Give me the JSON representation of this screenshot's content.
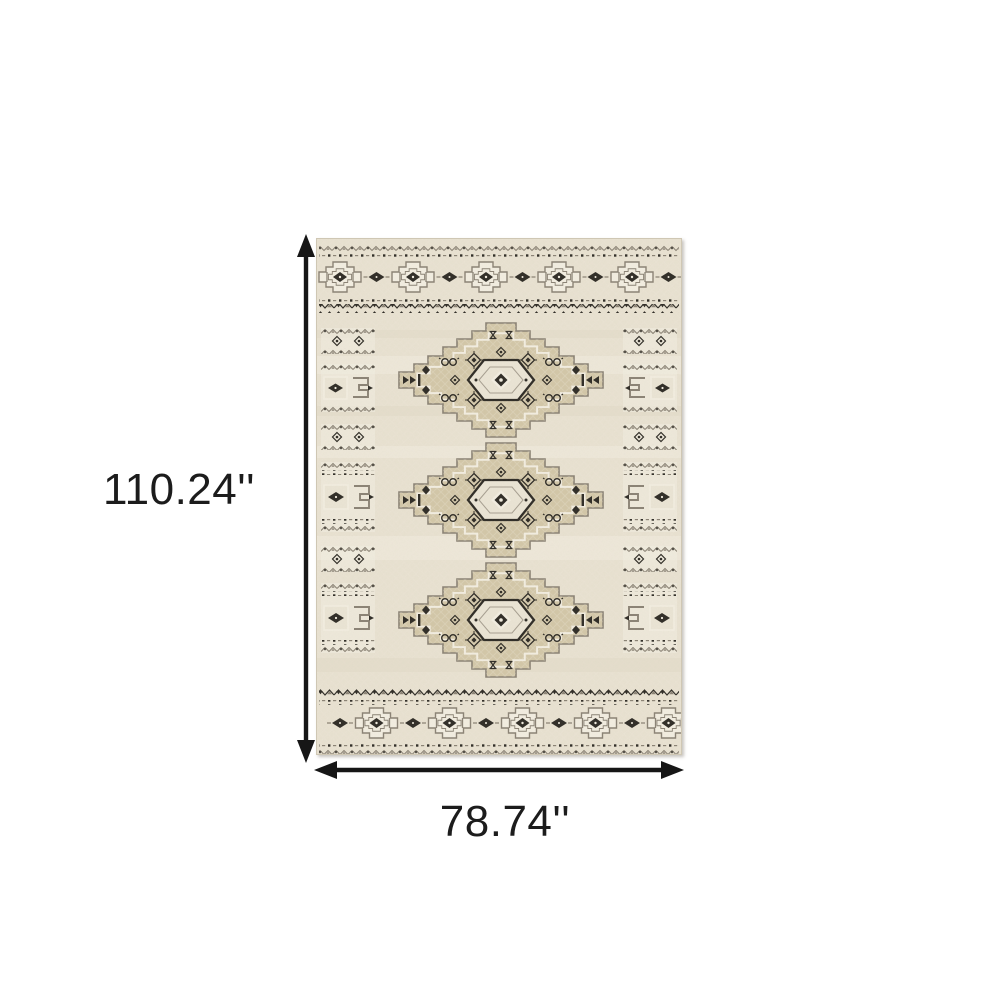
{
  "dimensions": {
    "height": "110.24''",
    "width": "78.74''"
  },
  "colors": {
    "dark": "#2e2b25",
    "gray": "#8a8274",
    "field": "#e9e2d1",
    "field_light": "#f3eee1",
    "tan": "#d3c7a8",
    "box": "#ebe5d5",
    "edge": "#cfc7b4",
    "arrow": "#161616",
    "label": "#1c1c1c",
    "background": "#ffffff"
  }
}
